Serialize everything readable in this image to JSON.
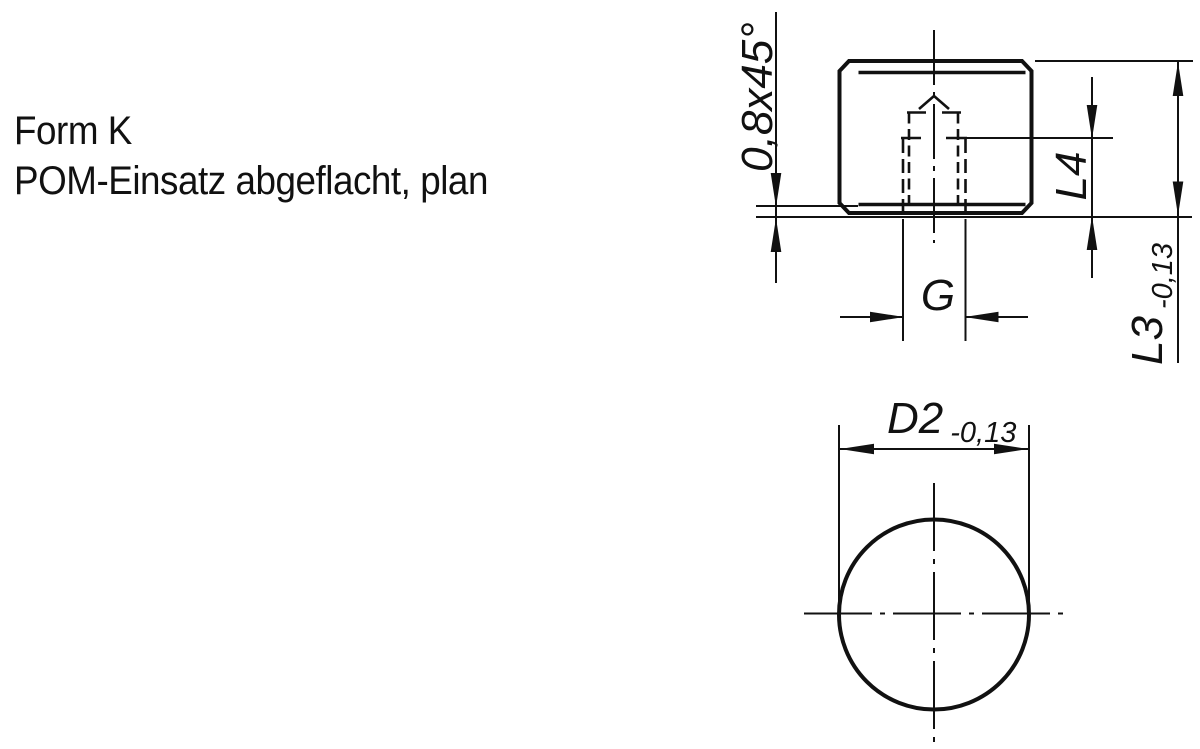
{
  "title": {
    "line1": "Form K",
    "line2": "POM-Einsatz abgeflacht, plan"
  },
  "drawing": {
    "colors": {
      "line": "#111111",
      "background": "#ffffff"
    },
    "front_view": {
      "dim_chamfer": {
        "label": "0,8x45°"
      },
      "dim_thread": {
        "label": "G"
      },
      "dim_insert_depth": {
        "label": "L4"
      },
      "dim_length": {
        "label": "L3",
        "tolerance": "-0,13"
      }
    },
    "bottom_view": {
      "dim_diameter": {
        "label": "D2",
        "tolerance": "-0,13"
      }
    }
  }
}
